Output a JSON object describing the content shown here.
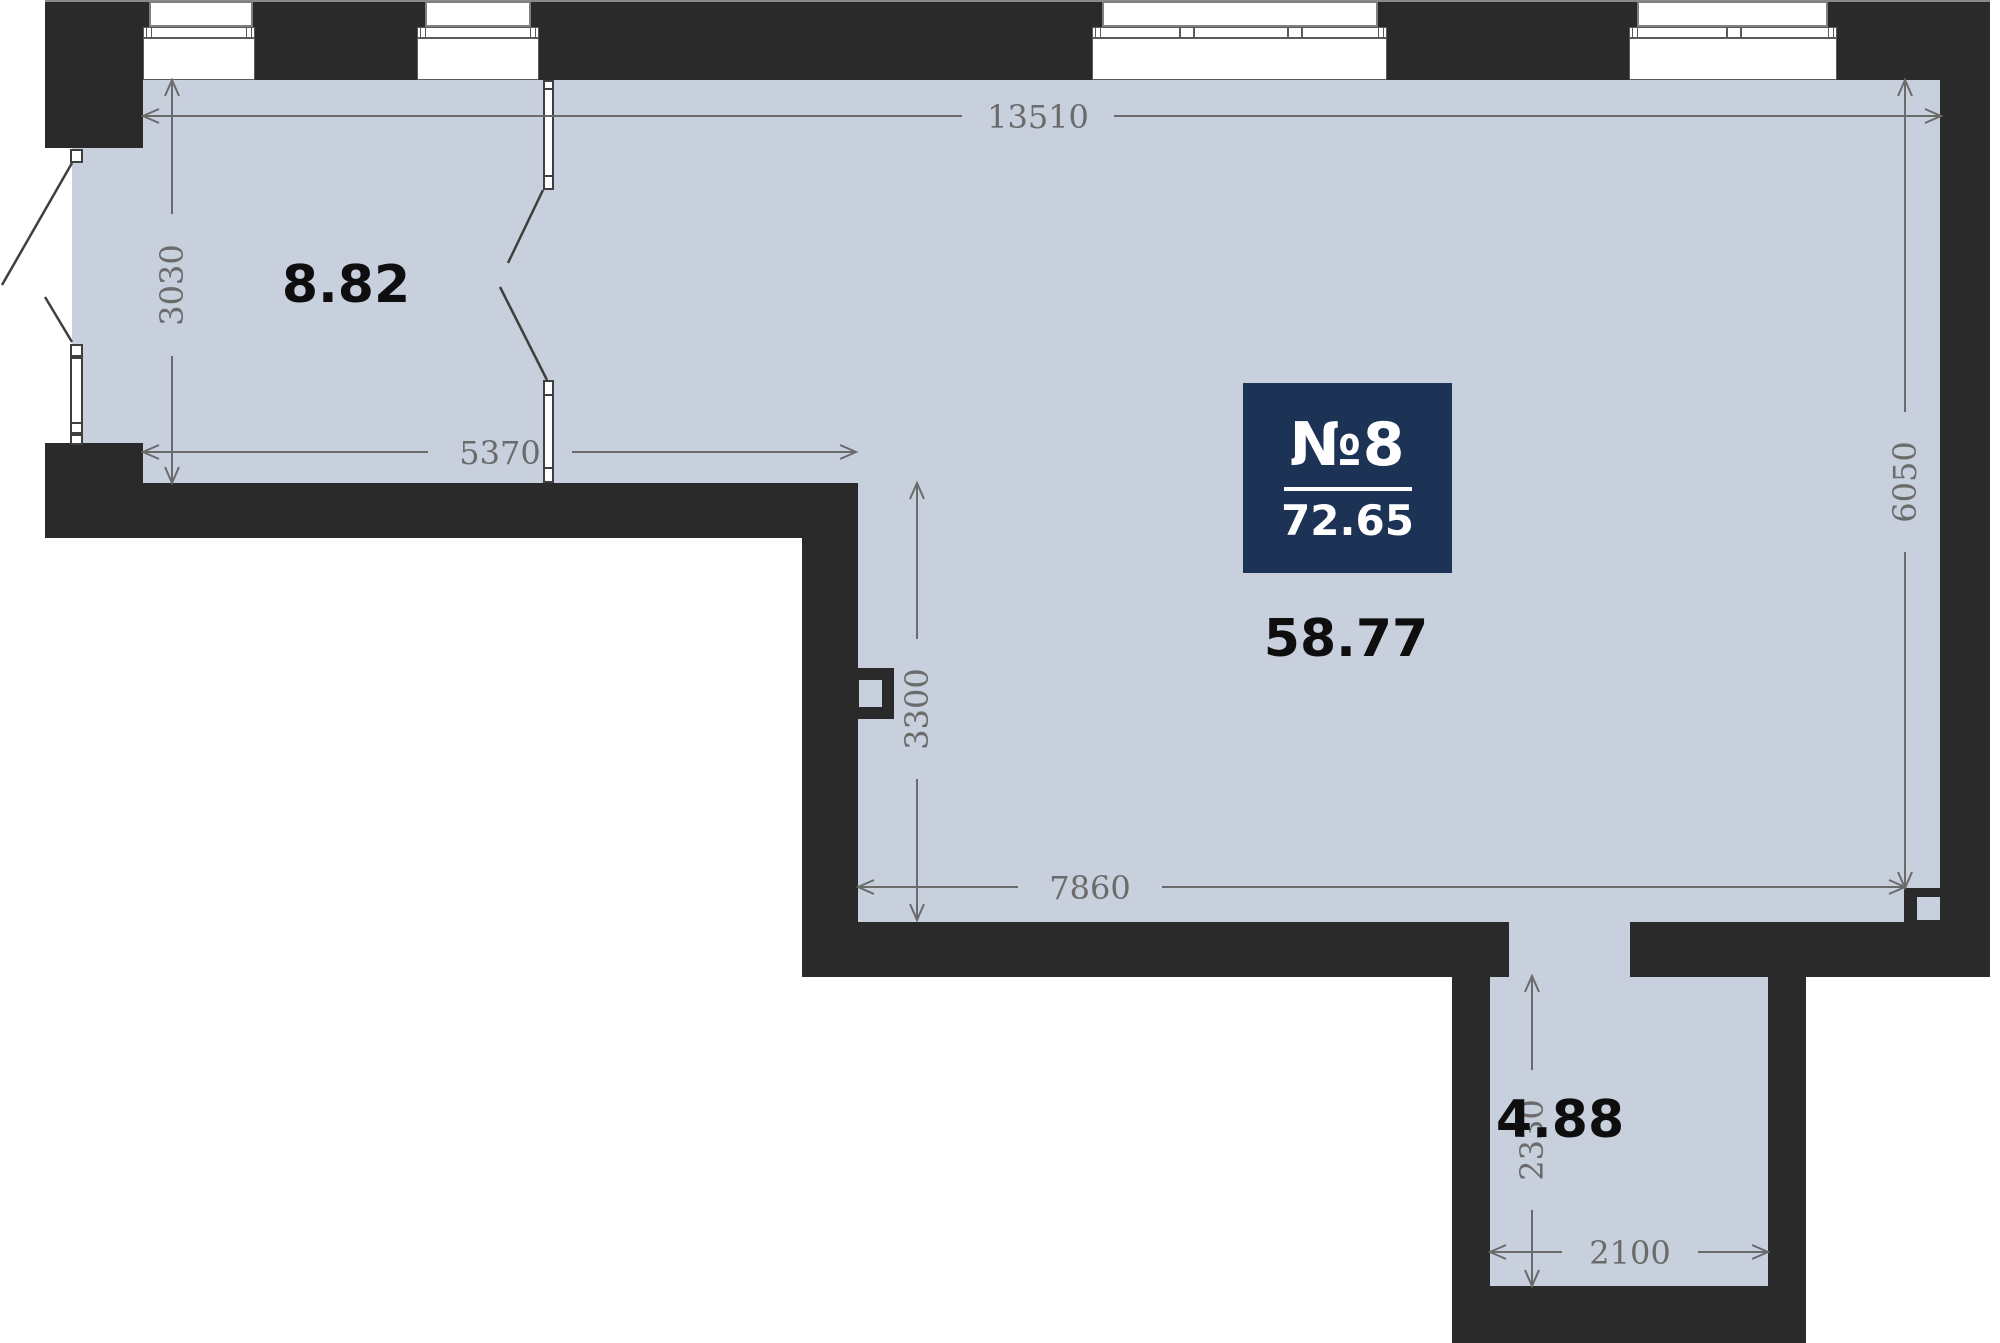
{
  "unit": {
    "number": "№8",
    "total_area": "72.65"
  },
  "rooms": [
    {
      "id": "room-top-left",
      "area": "8.82"
    },
    {
      "id": "room-main",
      "area": "58.77"
    },
    {
      "id": "room-hall",
      "area": "4.88"
    }
  ],
  "dimensions": {
    "top_width": "13510",
    "room1_height": "3030",
    "room1_width": "5370",
    "inner_height": "3300",
    "right_height": "6050",
    "bottom_width": "7860",
    "hall_height": "2330",
    "hall_width": "2100"
  },
  "colors": {
    "wall": "#2a2a2a",
    "floor": "#c7d0dc",
    "badge_background": "#1c3355",
    "dimension_text": "#6b6b6b",
    "area_text": "#0e0e0e"
  }
}
